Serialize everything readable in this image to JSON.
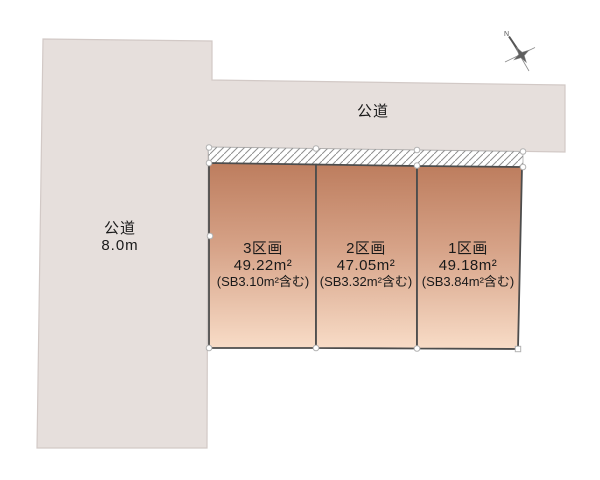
{
  "document": {
    "type": "land-plot-layout"
  },
  "colors": {
    "road_fill": "#e6dfdc",
    "road_stroke": "#d2c9c6",
    "plot_gradient_top": "#bd7d5e",
    "plot_gradient_mid": "#d6a287",
    "plot_gradient_bottom": "#f8dcc7",
    "plot_stroke": "#4d4d4d",
    "hatch_line": "#8f8f8f",
    "marker_stroke": "#b3b3b3",
    "text": "#1a1a1a"
  },
  "roads": {
    "left": {
      "name": "公道",
      "width_label": "8.0m"
    },
    "top": {
      "name": "公道"
    }
  },
  "plots": [
    {
      "name": "3区画",
      "area": "49.22m²",
      "setback_note": "(SB3.10m²含む)"
    },
    {
      "name": "2区画",
      "area": "47.05m²",
      "setback_note": "(SB3.32m²含む)"
    },
    {
      "name": "1区画",
      "area": "49.18m²",
      "setback_note": "(SB3.84m²含む)"
    }
  ],
  "compass": {
    "label": "N"
  }
}
